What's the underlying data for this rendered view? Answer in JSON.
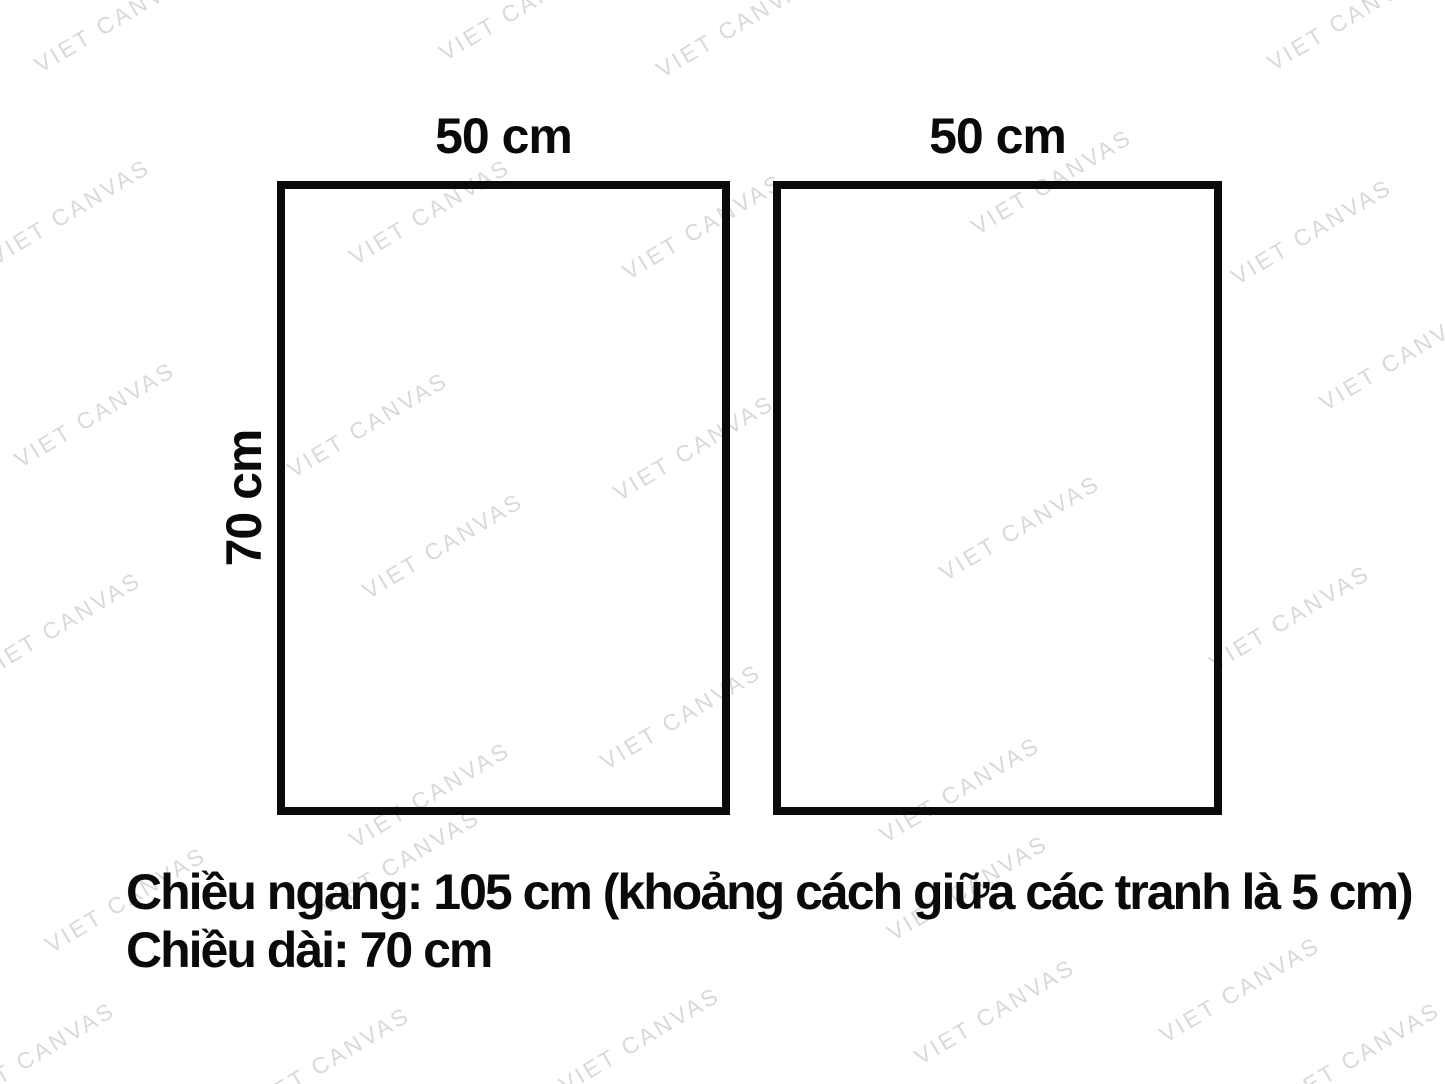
{
  "panels": [
    {
      "id": "panel1",
      "width_label": "50 cm"
    },
    {
      "id": "panel2",
      "width_label": "50 cm"
    }
  ],
  "height_label": "70 cm",
  "caption": {
    "line1": "Chiều ngang: 105 cm (khoảng cách giữa các tranh là 5 cm)",
    "line2": "Chiều dài: 70 cm"
  },
  "watermark": {
    "text": "VIET CANVAS",
    "color": "#d9d9d9",
    "angle_deg": -31,
    "positions": [
      [
        115,
        20
      ],
      [
        520,
        8
      ],
      [
        737,
        25
      ],
      [
        1348,
        18
      ],
      [
        70,
        212
      ],
      [
        430,
        212
      ],
      [
        703,
        227
      ],
      [
        1052,
        182
      ],
      [
        1312,
        232
      ],
      [
        95,
        415
      ],
      [
        368,
        425
      ],
      [
        694,
        448
      ],
      [
        1400,
        358
      ],
      [
        443,
        546
      ],
      [
        1020,
        528
      ],
      [
        61,
        625
      ],
      [
        1290,
        618
      ],
      [
        681,
        717
      ],
      [
        430,
        795
      ],
      [
        960,
        790
      ],
      [
        126,
        900
      ],
      [
        400,
        862
      ],
      [
        968,
        888
      ],
      [
        1240,
        990
      ],
      [
        35,
        1055
      ],
      [
        330,
        1060
      ],
      [
        640,
        1040
      ],
      [
        995,
        1012
      ],
      [
        1360,
        1055
      ]
    ]
  },
  "colors": {
    "ink": "#0a0a0a",
    "background": "#ffffff",
    "watermark": "#d9d9d9"
  }
}
